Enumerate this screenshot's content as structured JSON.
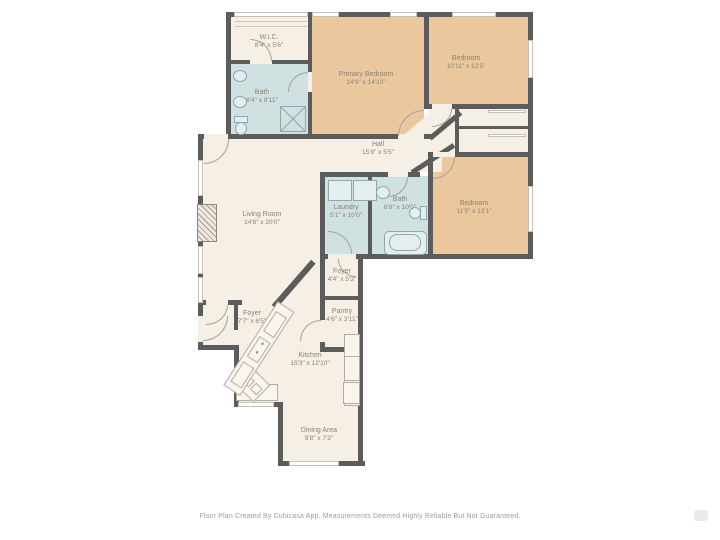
{
  "colors": {
    "wall": "#5c5c5c",
    "floor": "#f5efe6",
    "bedroom_floor": "#ebc79e",
    "wet_room_floor": "#cfe1e1",
    "label_text": "#8b8274",
    "footer_text": "#a09e99"
  },
  "rooms": [
    {
      "id": "wic",
      "name": "W.I.C.",
      "dims": "8'4\" x 5'6\""
    },
    {
      "id": "bath-primary",
      "name": "Bath",
      "dims": "8'4\" x 8'11\""
    },
    {
      "id": "primary-bedroom",
      "name": "Primary Bedroom",
      "dims": "14'9\" x 14'10\""
    },
    {
      "id": "bedroom-2",
      "name": "Bedroom",
      "dims": "10'11\" x 12'5\""
    },
    {
      "id": "hall",
      "name": "Hall",
      "dims": "15'8\" x 5'5\""
    },
    {
      "id": "living-room",
      "name": "Living Room",
      "dims": "14'6\" x 20'0\""
    },
    {
      "id": "laundry",
      "name": "Laundry",
      "dims": "5'1\" x 10'0\""
    },
    {
      "id": "bath-2",
      "name": "Bath",
      "dims": "6'8\" x 10'0\""
    },
    {
      "id": "bedroom-3",
      "name": "Bedroom",
      "dims": "11'5\" x 13'1\""
    },
    {
      "id": "foyer-upper",
      "name": "Foyer",
      "dims": "4'4\" x 5'3\""
    },
    {
      "id": "pantry",
      "name": "Pantry",
      "dims": "4'6\" x 3'11\""
    },
    {
      "id": "foyer-main",
      "name": "Foyer",
      "dims": "7'7\" x 6'5\""
    },
    {
      "id": "kitchen",
      "name": "Kitchen",
      "dims": "15'3\" x 12'10\""
    },
    {
      "id": "dining",
      "name": "Dining Area",
      "dims": "9'8\" x 7'3\""
    }
  ],
  "footer": {
    "disclaimer": "Floor Plan Created By Cubicasa App. Measurements Deemed Highly Reliable But Not Guaranteed."
  }
}
